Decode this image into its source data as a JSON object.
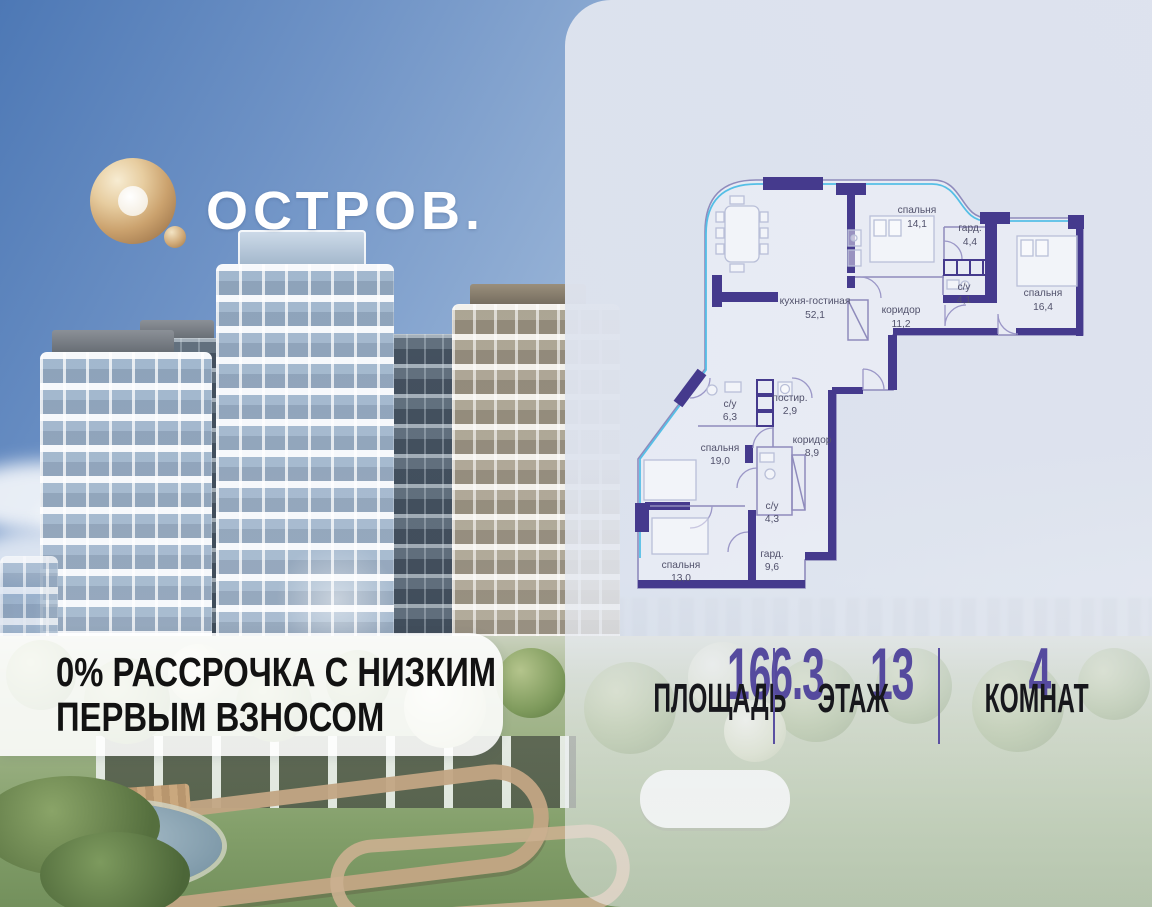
{
  "brand": {
    "logo_text": "ОСТРОВ."
  },
  "promo": {
    "line1": "0% РАССРОЧКА С НИЗКИМ",
    "line2": "ПЕРВЫМ ВЗНОСОМ"
  },
  "stats": [
    {
      "value": "166.3",
      "label": "ПЛОЩАДЬ"
    },
    {
      "value": "13",
      "label": "ЭТАЖ"
    },
    {
      "value": "4",
      "label": "КОМНАТ"
    }
  ],
  "floorplan": {
    "rooms": [
      {
        "name": "спальня",
        "area": "14,1"
      },
      {
        "name": "гард.",
        "area": "4,4"
      },
      {
        "name": "с/у",
        "area": "4,1"
      },
      {
        "name": "спальня",
        "area": "16,4"
      },
      {
        "name": "кухня-гостиная",
        "area": "52,1"
      },
      {
        "name": "коридор",
        "area": "11,2"
      },
      {
        "name": "с/у",
        "area": "6,3"
      },
      {
        "name": "постир.",
        "area": "2,9"
      },
      {
        "name": "спальня",
        "area": "19,0"
      },
      {
        "name": "коридор",
        "area": "8,9"
      },
      {
        "name": "с/у",
        "area": "4,3"
      },
      {
        "name": "гард.",
        "area": "9,6"
      },
      {
        "name": "спальня",
        "area": "13,0"
      }
    ]
  },
  "colors": {
    "accent_purple": "#554a9e",
    "wall_purple": "#453a8d",
    "glazing_cyan": "#55bfe6",
    "logo_gold": "#cfa775",
    "panel_bg": "#dfe3ee"
  }
}
